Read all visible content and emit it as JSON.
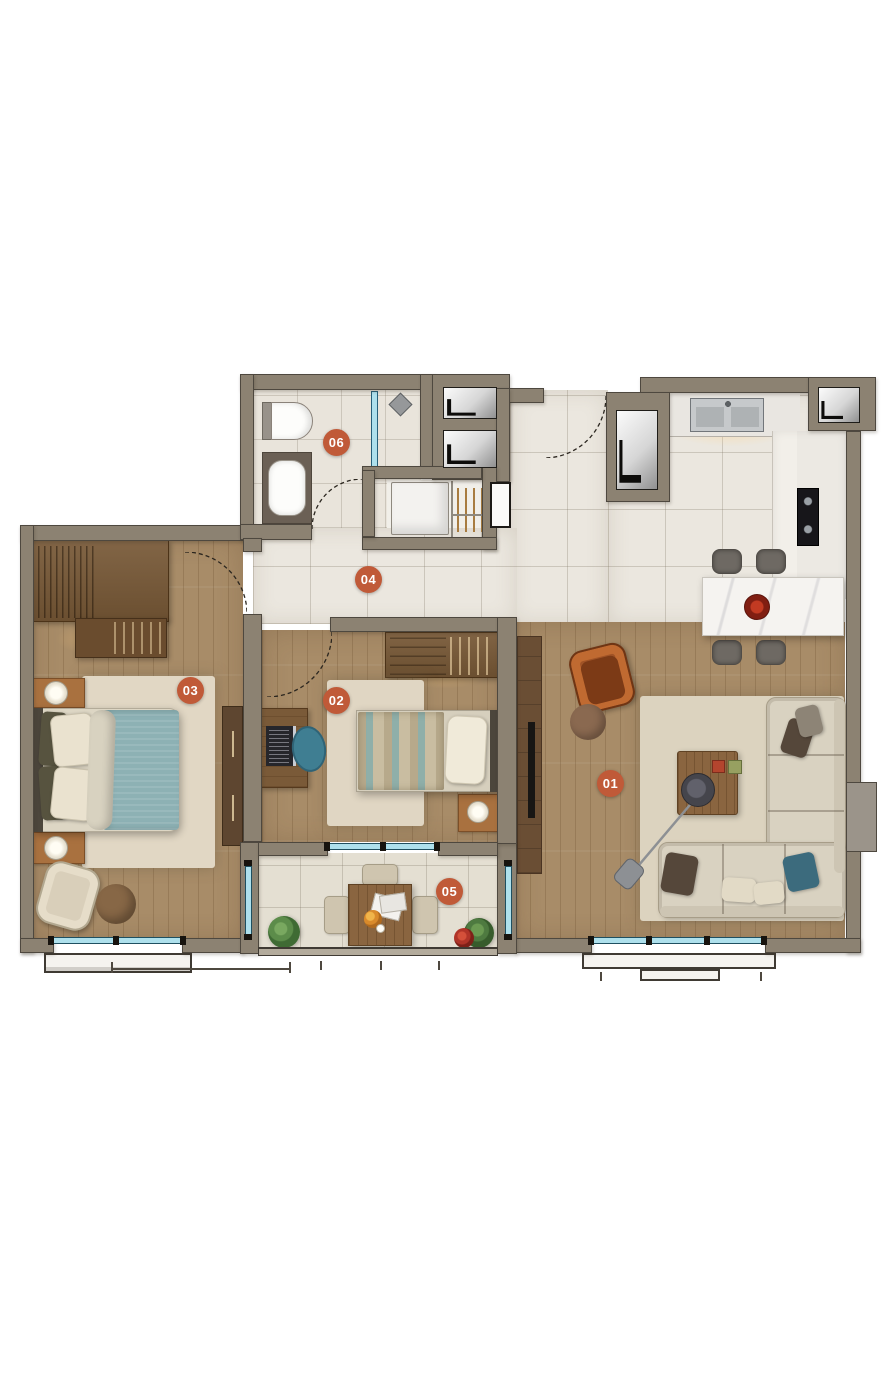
{
  "rooms": [
    {
      "label": "01",
      "name": "living-room"
    },
    {
      "label": "02",
      "name": "bedroom-2"
    },
    {
      "label": "03",
      "name": "bedroom-1"
    },
    {
      "label": "04",
      "name": "hall"
    },
    {
      "label": "05",
      "name": "balcony"
    },
    {
      "label": "06",
      "name": "bathroom"
    }
  ],
  "colors": {
    "room_label_bg": "#c05a38",
    "room_label_text": "#ffffff",
    "wall": "#8c8272",
    "wood_floor": "#a88c68",
    "tile_floor": "#ebe7df",
    "window_glass": "#aee0ec",
    "sofa": "#d9d2c1",
    "bed_duvet": "#8db1b4",
    "accent_chair": "#a05326"
  }
}
